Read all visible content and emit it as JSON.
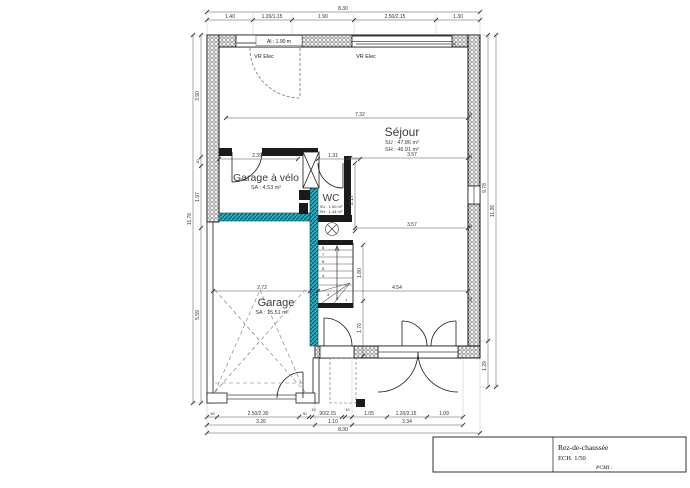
{
  "title_block": {
    "title": "Rez-de-chaussée",
    "scale": "ECH. 1/50",
    "ref": "PCMI :"
  },
  "rooms": {
    "sejour": {
      "name": "Séjour",
      "su": "SU : 47.86 m²",
      "sh": "SH : 46.91 m²"
    },
    "garage_velo": {
      "name": "Garage à vélo",
      "sa": "SA : 4.53 m²"
    },
    "wc": {
      "name": "WC",
      "su": "SU : 1.50 m²",
      "sh": "SH : 1.44 m²"
    },
    "garage": {
      "name": "Garage",
      "sa": "SA : 15.51 m²"
    }
  },
  "annotations": {
    "vr_elec": "VR Elec",
    "allege": "Al : 1.90 m"
  },
  "dims": {
    "top": {
      "total": "8.30",
      "segments": [
        "1.40",
        "1.20/1.15",
        "1.90",
        "2.50/2.15",
        "1.30"
      ]
    },
    "bottom": {
      "row1": [
        ".30",
        "2.50/2.30",
        ".30",
        ".10",
        ".90/2.15",
        ".10",
        "1.05",
        "1.20/2.15",
        "1.09"
      ],
      "row2": [
        "3.26",
        "1.10",
        "3.34"
      ],
      "total": "8.30"
    },
    "left": {
      "total": "11.76",
      "segments": [
        "3.90",
        ".30",
        "1.97",
        "5.59"
      ]
    },
    "right": {
      "inner": "9.78",
      "outer": "11.26",
      "bottom": "1.29",
      "wall_tick": ".30"
    },
    "interior": {
      "w732": "7.32",
      "w357a": "3.57",
      "w357b": "3.57",
      "w454": "4.54",
      "w272": "2.72",
      "w239": "2.39",
      "w131": "1.31",
      "v217": "2.17",
      "v180": "1.80",
      "v176": "1.76"
    }
  },
  "stairs": {
    "steps": [
      "1",
      "2",
      "3",
      "4",
      "5",
      "6",
      "7",
      "8"
    ]
  },
  "colors": {
    "teal_wall": "#2fa9bd",
    "teal_dark": "#0a5560",
    "line": "#1a1a1a"
  }
}
